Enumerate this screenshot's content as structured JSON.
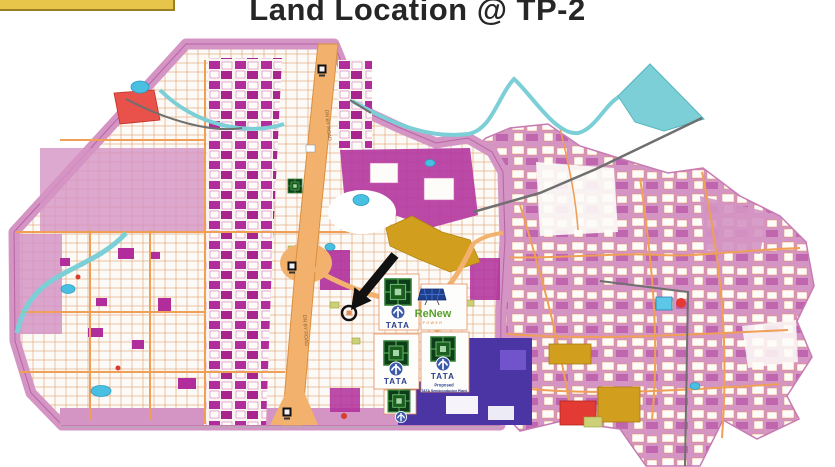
{
  "slide": {
    "title": "Land Location @ TP-2"
  },
  "map": {
    "road_label": "DN BY ROAD",
    "logos": {
      "tata_wordmark": "TATA",
      "renew_wordmark": "ReNew",
      "renew_subtext": "POWER",
      "proposed_line1": "Proposed",
      "proposed_line2": "TATA Semiconductor Plant"
    },
    "colors": {
      "accent_bar": "#e7c54b",
      "parcel_pink": "#d494c4",
      "parcel_magenta": "#b02d9b",
      "road_orange": "#f2b26e",
      "water_teal": "#7ccfd6",
      "tata_site_indigo": "#4b34a4",
      "gold_zone": "#d29e1e",
      "tata_blue": "#283c8f",
      "renew_green": "#5aa02c",
      "highlight_red": "#e8524a"
    }
  }
}
